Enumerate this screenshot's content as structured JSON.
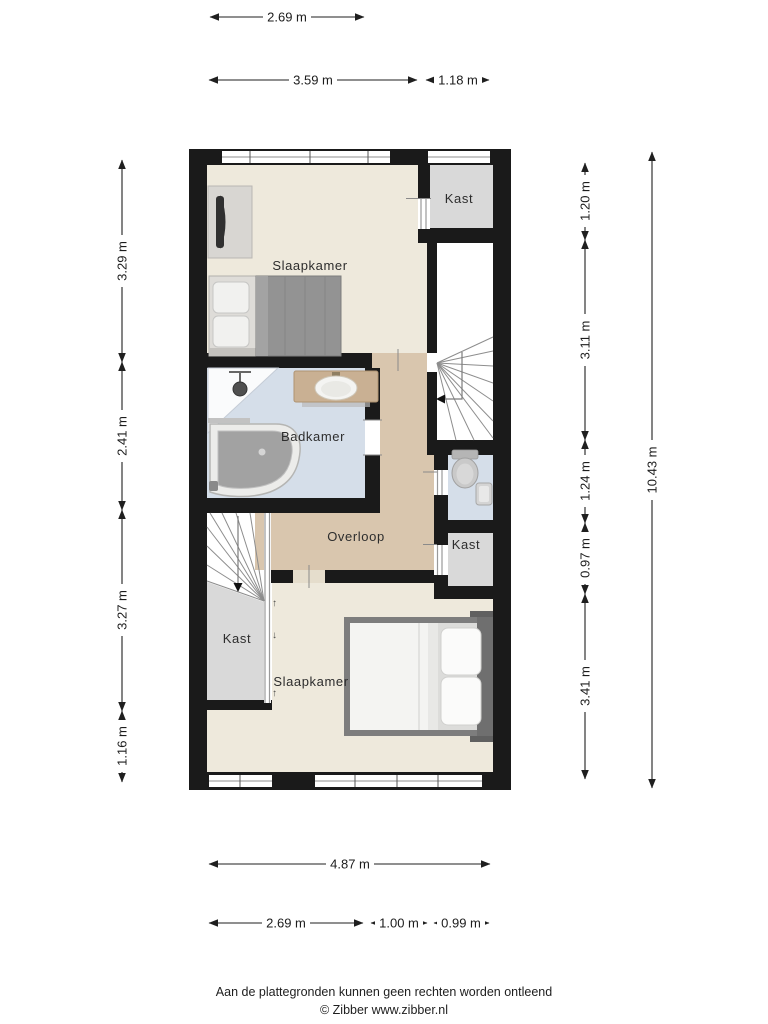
{
  "rooms": {
    "slaapkamer_top": "Slaapkamer",
    "kast_top_right": "Kast",
    "badkamer": "Badkamer",
    "overloop": "Overloop",
    "kast_right": "Kast",
    "kast_bottom_left": "Kast",
    "slaapkamer_bottom": "Slaapkamer"
  },
  "dimensions": {
    "top_row1": "2.69 m",
    "top_row2a": "3.59 m",
    "top_row2b": "1.18 m",
    "left": [
      "3.29 m",
      "2.41 m",
      "3.27 m",
      "1.16 m"
    ],
    "right": [
      "1.20 m",
      "3.11 m",
      "1.24 m",
      "0.97 m",
      "3.41 m"
    ],
    "total_height": "10.43 m",
    "bottom_row1": "4.87 m",
    "bottom_row2": [
      "2.69 m",
      "1.00 m",
      "0.99 m"
    ]
  },
  "stair_symbols": {
    "up": "↑",
    "down": "↓"
  },
  "footer": {
    "disclaimer": "Aan de plattegronden kunnen geen rechten worden ontleend",
    "copyright": "© Zibber www.zibber.nl"
  },
  "colors": {
    "wall": "#1a1a1a",
    "floor_bedroom": "#eee9dc",
    "floor_landing": "#d9c6ae",
    "floor_bathroom": "#d5dee9",
    "floor_closet": "#d9d9d9",
    "dimension_text": "#1c1c1c"
  }
}
